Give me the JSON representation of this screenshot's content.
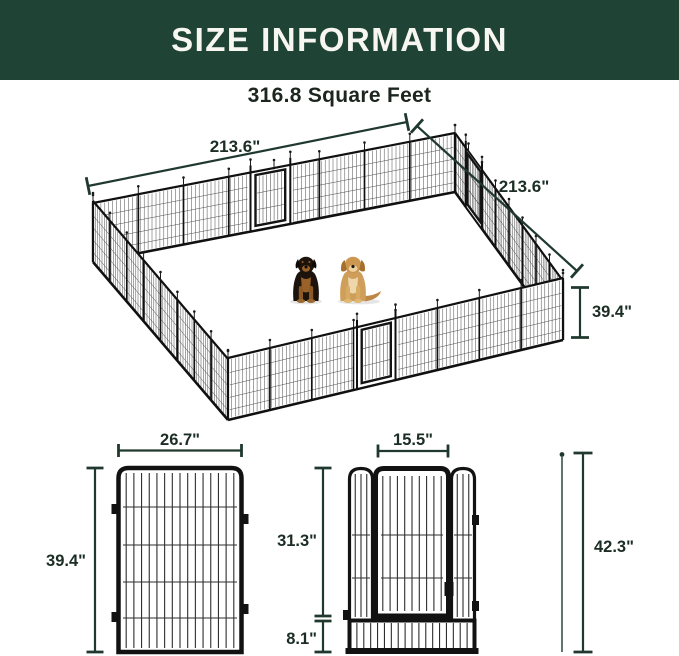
{
  "header": {
    "title": "SIZE INFORMATION"
  },
  "overview": {
    "area_label": "316.8 Square Feet",
    "side_length_left": "213.6\"",
    "side_length_right": "213.6\"",
    "panel_height": "39.4\""
  },
  "panel_detail": {
    "width": "26.7\"",
    "height": "39.4\""
  },
  "gate_detail": {
    "door_width": "15.5\"",
    "door_height": "31.3\"",
    "bottom_height": "8.1\"",
    "total_height": "42.3\""
  },
  "colors": {
    "header_bg": "#1f4436",
    "dimension_line": "#20392f",
    "dimension_text": "#1c2d25",
    "steel": "#121212"
  }
}
